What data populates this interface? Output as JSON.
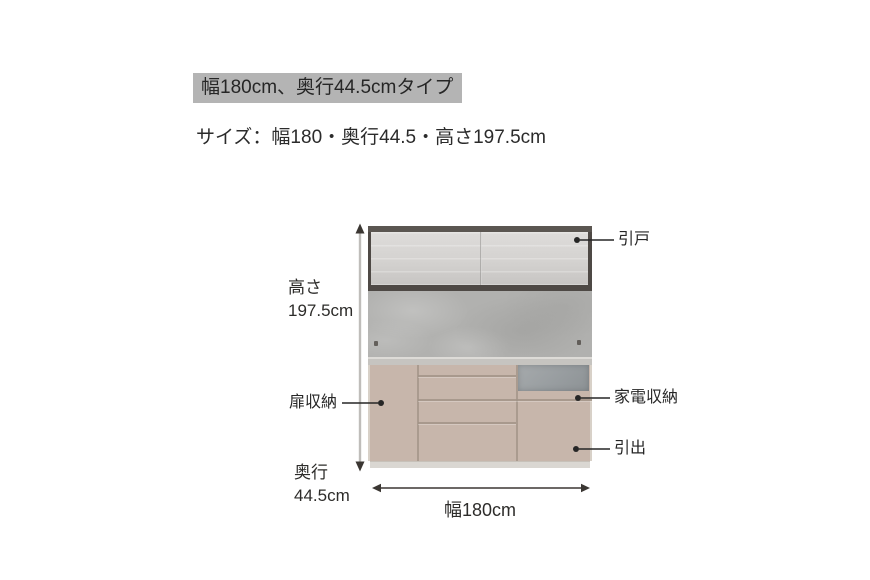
{
  "page": {
    "title": "幅180cm、奥行44.5cmタイプ",
    "subtitle": "サイズ：幅180・奥行44.5・高さ197.5cm"
  },
  "diagram": {
    "dimensions": {
      "height": {
        "title": "高さ",
        "value": "197.5cm"
      },
      "depth": {
        "title": "奥行",
        "value": "44.5cm"
      },
      "width": {
        "value": "幅180cm"
      }
    },
    "callouts": {
      "sliding_door": "引戸",
      "door_storage": "扉収納",
      "appliance_storage": "家電収納",
      "drawer": "引出"
    },
    "colors": {
      "title_badge_bg": "#b4b4b4",
      "upper_frame": "#4e4945",
      "upper_door": "#d6d4d2",
      "backsplash": "#b1b1af",
      "countertop": "#c6c4c0",
      "cabinet_body": "#c7b6ab",
      "groove": "#a09286",
      "appliance_opening": "#989da0",
      "plinth": "#dad7d2",
      "annotation_dark": "#3b3733",
      "dimension_line_gray": "#bfbdba"
    }
  }
}
